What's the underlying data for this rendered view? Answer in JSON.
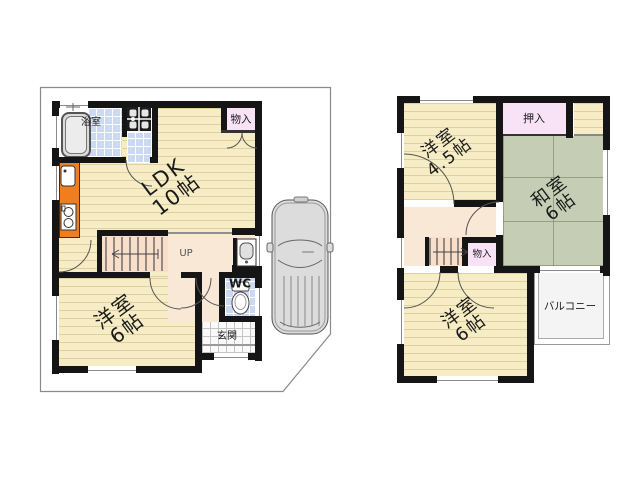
{
  "floors": {
    "f1": {
      "rooms": {
        "ldk": {
          "line1": "LDK",
          "line2": "10帖"
        },
        "yoshitsu6": {
          "line1": "洋室",
          "line2": "6帖"
        },
        "bath": {
          "label": "浴室"
        },
        "storage": {
          "label": "物入"
        },
        "wc": {
          "label": "WC"
        },
        "genkan": {
          "label": "玄関"
        },
        "stairs": {
          "label": "UP"
        }
      }
    },
    "f2": {
      "rooms": {
        "yoshitsu45": {
          "line1": "洋室",
          "line2": "4.5帖"
        },
        "washitsu6": {
          "line1": "和室",
          "line2": "6帖"
        },
        "yoshitsu6": {
          "line1": "洋室",
          "line2": "6帖"
        },
        "oshiire": {
          "label": "押入"
        },
        "storage": {
          "label": "物入"
        },
        "balcony": {
          "label": "バルコニー"
        }
      }
    }
  },
  "fixtures": {
    "car": "car-top-view",
    "bathtub": "bathtub",
    "washing_machine": "washing-machine",
    "washbasin": "washbasin",
    "toilet": "toilet",
    "kitchen_sink": "kitchen-sink",
    "stove": "two-burner-stove"
  },
  "colors": {
    "wall": "#151515",
    "wood_floor": "#F6EDC6",
    "tatami_green": "#C5CEB5",
    "closet_pink": "#F8E2F6",
    "tile_blue": "#CBD9F2",
    "kitchen_orange": "#F07D1E",
    "hall_cream": "#FAE8D6",
    "car_gray": "#DCDCDC"
  }
}
